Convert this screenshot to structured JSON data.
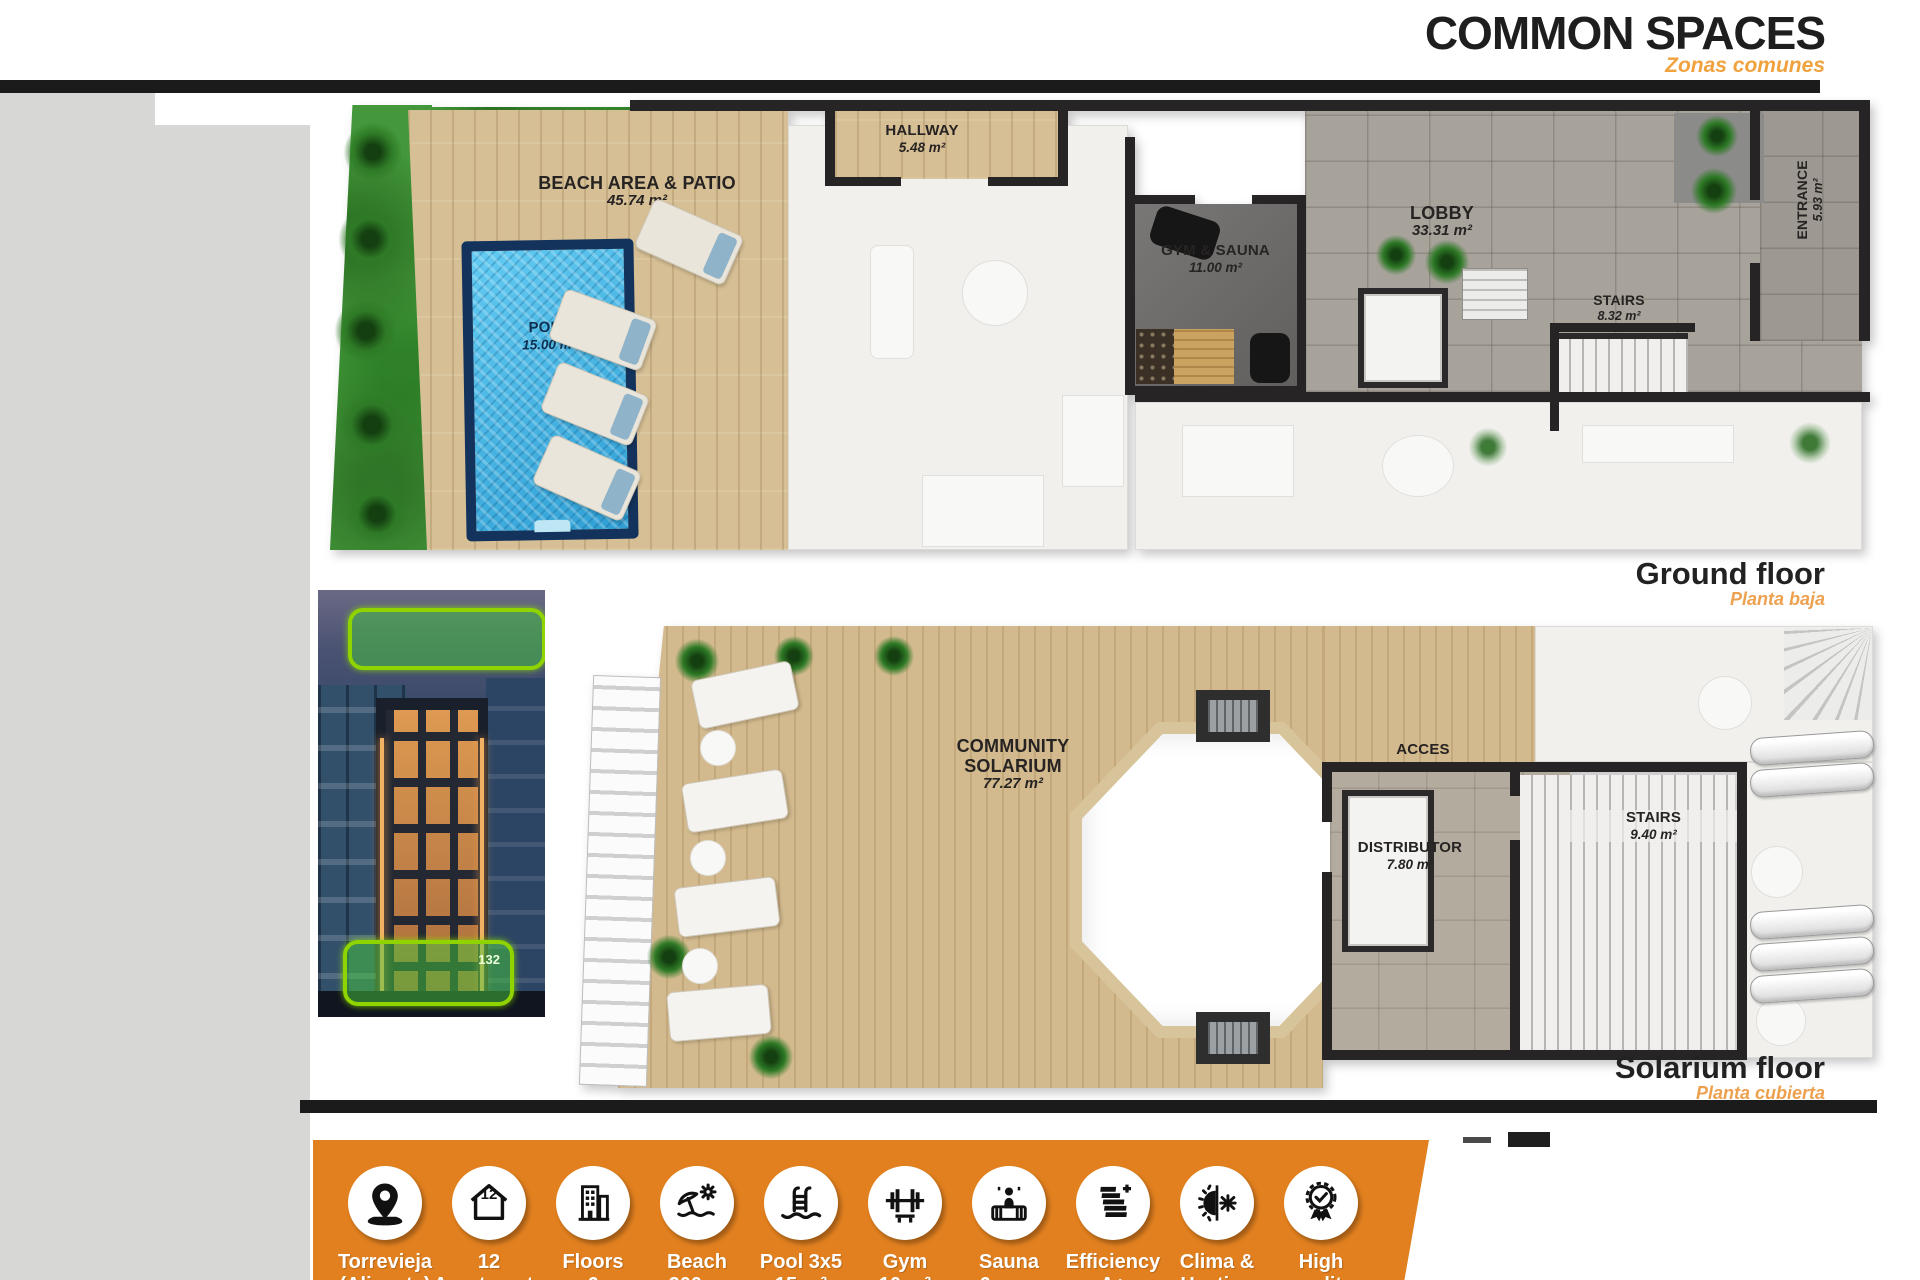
{
  "header": {
    "title": "COMMON SPACES",
    "subtitle": "Zonas comunes"
  },
  "ground_floor": {
    "caption": "Ground floor",
    "caption_es": "Planta baja",
    "rooms": {
      "beach": {
        "name": "BEACH AREA & PATIO",
        "area": "45.74 m²"
      },
      "pool": {
        "name": "POLL",
        "area": "15.00 m²"
      },
      "hallway": {
        "name": "HALLWAY",
        "area": "5.48 m²"
      },
      "gym": {
        "name": "GYM & SAUNA",
        "area": "11.00 m²"
      },
      "lobby": {
        "name": "LOBBY",
        "area": "33.31 m²"
      },
      "stairs": {
        "name": "STAIRS",
        "area": "8.32 m²"
      },
      "entrance": {
        "name": "ENTRANCE",
        "area": "5.93 m²"
      }
    }
  },
  "solarium_floor": {
    "caption": "Solarium floor",
    "caption_es": "Planta cubierta",
    "rooms": {
      "solarium": {
        "name": "COMMUNITY SOLARIUM",
        "area": "77.27 m²"
      },
      "acces": {
        "name": "ACCES"
      },
      "distributor": {
        "name": "DISTRIBUTOR",
        "area": "7.80 m²"
      },
      "stairs": {
        "name": "STAIRS",
        "area": "9.40 m²"
      }
    }
  },
  "photo": {
    "badge": "132"
  },
  "features": [
    {
      "icon": "location-pin-icon",
      "line1": "Torrevieja",
      "line2": "(Alicante)"
    },
    {
      "icon": "house-count-icon",
      "line1": "12",
      "line2": "Apartments"
    },
    {
      "icon": "building-icon",
      "line1": "Floors",
      "line2": "6"
    },
    {
      "icon": "beach-icon",
      "line1": "Beach",
      "line2": "200 m"
    },
    {
      "icon": "pool-ladder-icon",
      "line1": "Pool 3x5",
      "line2": "15 m²"
    },
    {
      "icon": "gym-icon",
      "line1": "Gym",
      "line2": "10 m²"
    },
    {
      "icon": "sauna-icon",
      "line1": "Sauna",
      "line2": "6 pers"
    },
    {
      "icon": "efficiency-icon",
      "line1": "Efficiency",
      "line2": "A+"
    },
    {
      "icon": "climate-icon",
      "line1": "Clima &",
      "line2": "Heating"
    },
    {
      "icon": "quality-icon",
      "line1": "High",
      "line2": "quality"
    }
  ],
  "colors": {
    "accent_orange": "#E2801F",
    "subtitle_orange": "#F0A23E",
    "highlight_green": "#8FD400",
    "title_dark": "#1E1E1E",
    "pool_blue": "#3FB0E0"
  }
}
